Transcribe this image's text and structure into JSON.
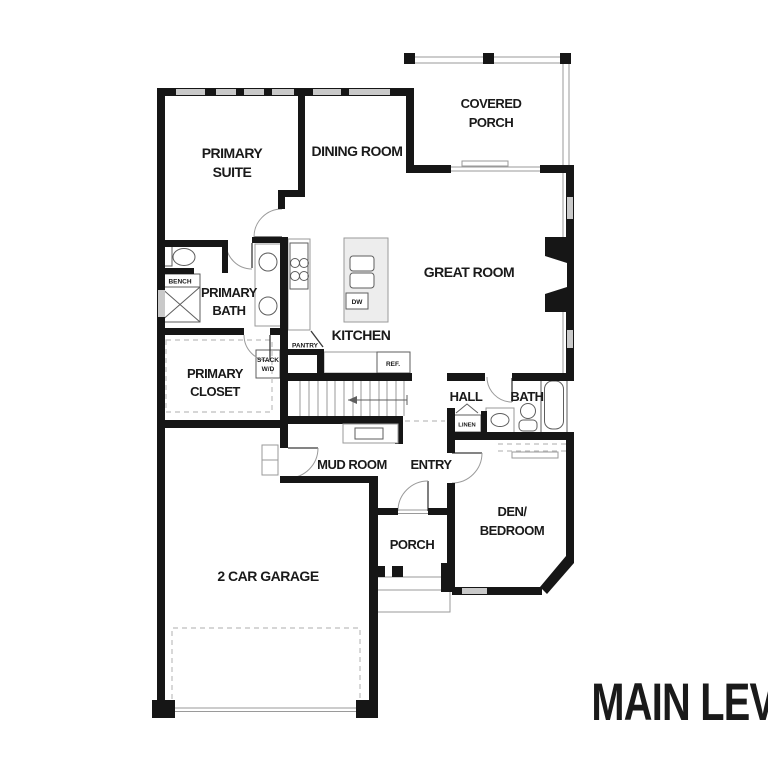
{
  "plan_title": "MAIN LEVEL",
  "rooms": {
    "primary_suite": {
      "line1": "PRIMARY",
      "line2": "SUITE"
    },
    "dining_room": {
      "label": "DINING ROOM"
    },
    "covered_porch": {
      "line1": "COVERED",
      "line2": "PORCH"
    },
    "great_room": {
      "label": "GREAT ROOM"
    },
    "primary_bath": {
      "line1": "PRIMARY",
      "line2": "BATH"
    },
    "primary_closet": {
      "line1": "PRIMARY",
      "line2": "CLOSET"
    },
    "kitchen": {
      "label": "KITCHEN"
    },
    "hall": {
      "label": "HALL"
    },
    "bath": {
      "label": "BATH"
    },
    "mud_room": {
      "label": "MUD ROOM"
    },
    "entry": {
      "label": "ENTRY"
    },
    "den_bedroom": {
      "line1": "DEN/",
      "line2": "BEDROOM"
    },
    "porch": {
      "label": "PORCH"
    },
    "garage": {
      "label": "2 CAR GARAGE"
    }
  },
  "fixtures": {
    "bath_bench": "BENCH",
    "mud_bench": "BENCH",
    "pantry": "PANTRY",
    "stack_line1": "STACK",
    "stack_line2": "W/D",
    "dishwasher": "DW",
    "refrigerator": "REF.",
    "linen": "LINEN"
  },
  "colors": {
    "wall": "#161616",
    "window": "#c9c9c9",
    "thin_line": "#9a9a9a",
    "text": "#1a1a1a",
    "background": "#ffffff"
  }
}
